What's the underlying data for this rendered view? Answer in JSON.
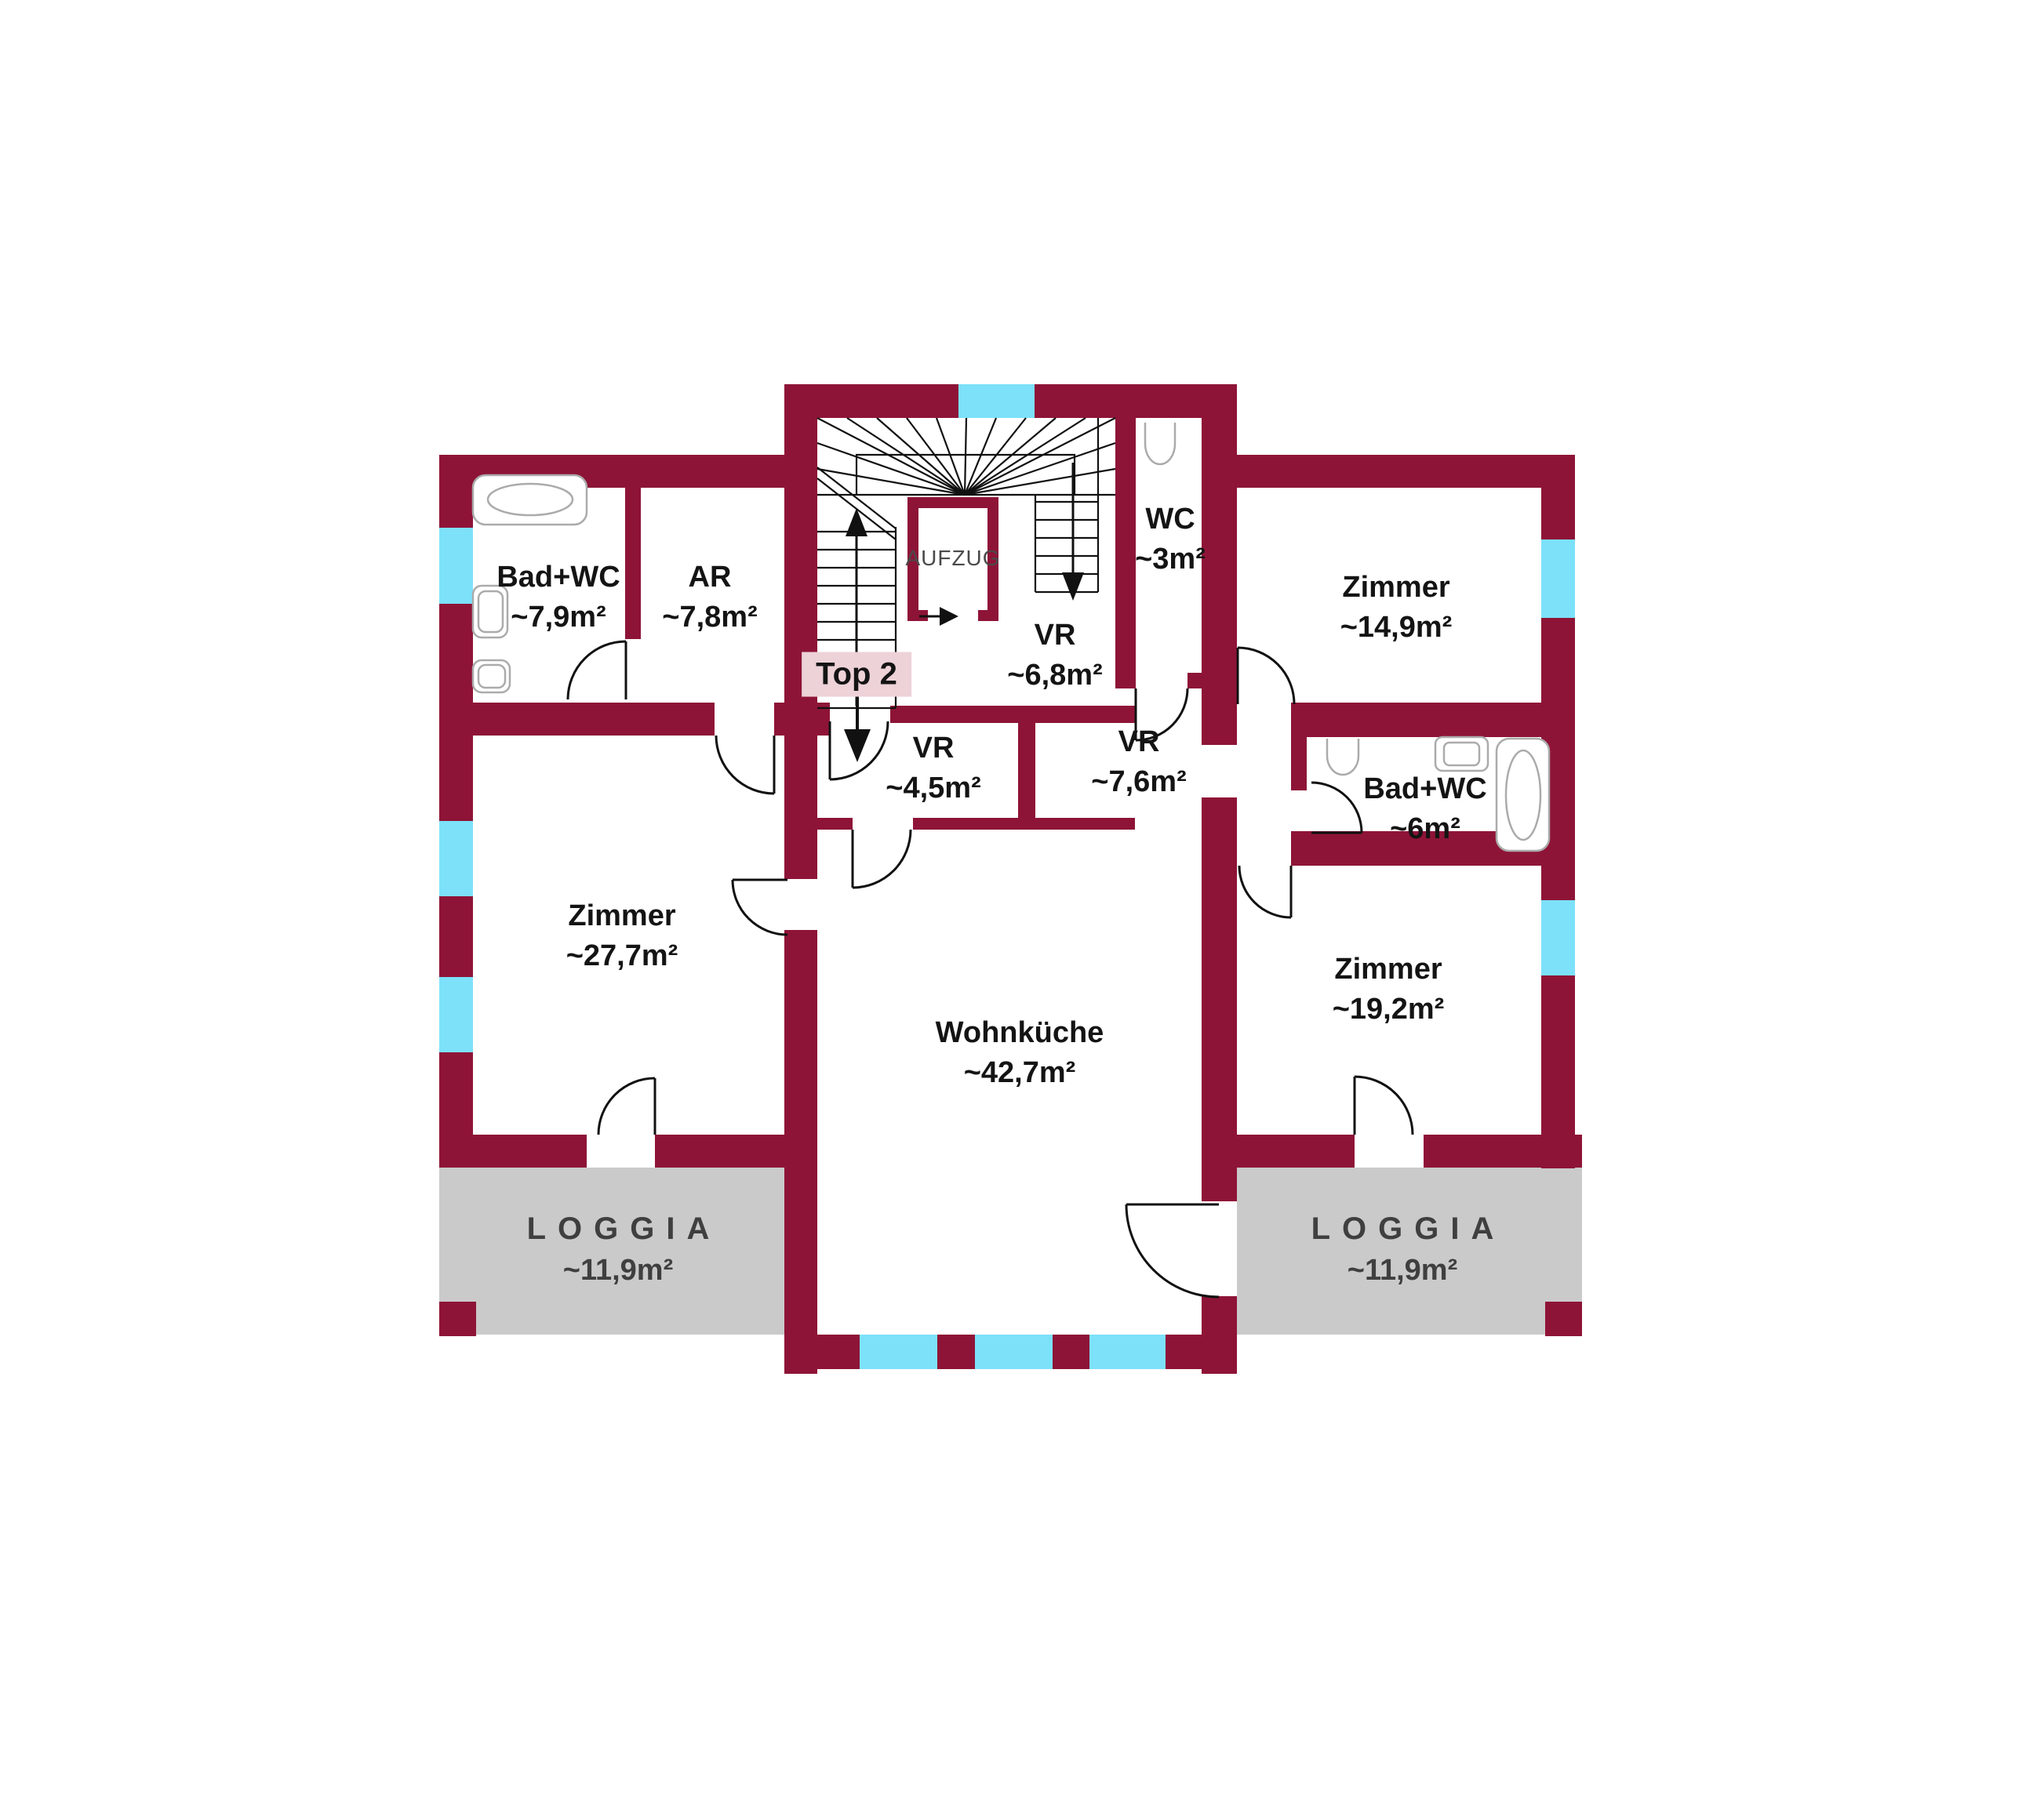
{
  "labels": {
    "elevator": "AUFZUG",
    "unit": "Top 2"
  },
  "rooms": {
    "badwc_left": {
      "name": "Bad+WC",
      "area": "~7,9m²"
    },
    "ar": {
      "name": "AR",
      "area": "~7,8m²"
    },
    "wc": {
      "name": "WC",
      "area": "~3m²"
    },
    "zimmer_149": {
      "name": "Zimmer",
      "area": "~14,9m²"
    },
    "vr_68": {
      "name": "VR",
      "area": "~6,8m²"
    },
    "vr_45": {
      "name": "VR",
      "area": "~4,5m²"
    },
    "vr_76": {
      "name": "VR",
      "area": "~7,6m²"
    },
    "badwc_6": {
      "name": "Bad+WC",
      "area": "~6m²"
    },
    "zimmer_277": {
      "name": "Zimmer",
      "area": "~27,7m²"
    },
    "wohnkueche": {
      "name": "Wohnküche",
      "area": "~42,7m²"
    },
    "zimmer_192": {
      "name": "Zimmer",
      "area": "~19,2m²"
    },
    "loggia_left": {
      "name": "LOGGIA",
      "area": "~11,9m²"
    },
    "loggia_right": {
      "name": "LOGGIA",
      "area": "~11,9m²"
    }
  },
  "colors": {
    "wall": "#8E1437",
    "window": "#7DE1FA",
    "loggia": "#CACACA",
    "unit_badge_bg": "#EDD2D8",
    "label_text": "#141414",
    "loggia_text": "#3F3F3F",
    "fixture_stroke": "#ABABAB",
    "door_stroke": "#111111"
  }
}
